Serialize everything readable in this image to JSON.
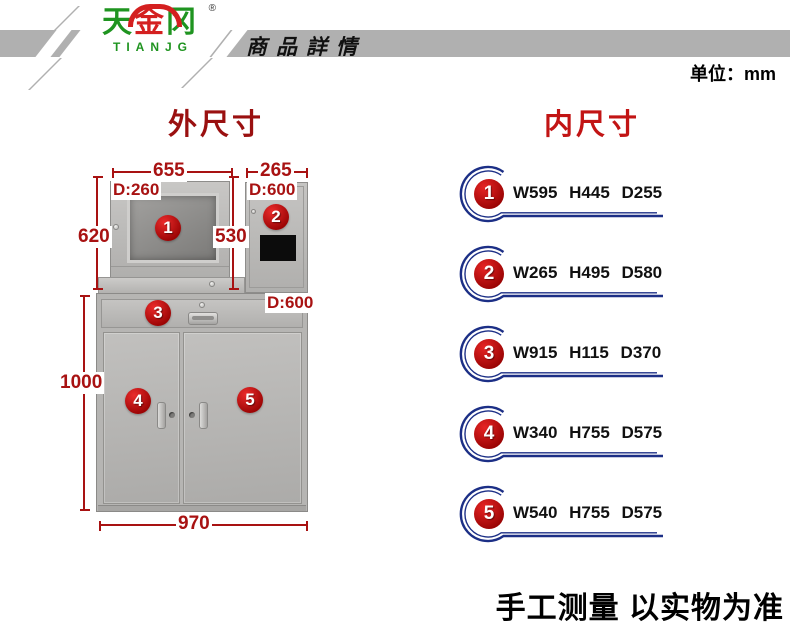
{
  "header": {
    "brand": {
      "tian": "天",
      "jin": "金",
      "gang": "冈",
      "reg": "®",
      "latin": "TIANJG"
    },
    "title": "商品詳情",
    "unit_label": "单位：mm"
  },
  "sections": {
    "outer_title": "外尺寸",
    "inner_title": "内尺寸"
  },
  "diagram": {
    "dims": {
      "top_width": "655",
      "top_right_width": "265",
      "depth_monitor": "D:260",
      "depth_right_top": "D:600",
      "height_left": "620",
      "height_mid": "530",
      "depth_lower": "D:600",
      "height_lower": "1000",
      "bottom_width": "970"
    },
    "badges": [
      "1",
      "2",
      "3",
      "4",
      "5"
    ]
  },
  "inner_list": {
    "items": [
      {
        "num": "1",
        "spec": "W595 H445 D255"
      },
      {
        "num": "2",
        "spec": "W265 H495 D580"
      },
      {
        "num": "3",
        "spec": "W915 H115 D370"
      },
      {
        "num": "4",
        "spec": "W340 H755 D575"
      },
      {
        "num": "5",
        "spec": "W540 H755 D575"
      }
    ]
  },
  "footer": {
    "note": "手工测量 以实物为准"
  },
  "colors": {
    "accent_red": "#a81212",
    "badge_red": "#c00000",
    "swirl_blue": "#1c2f86",
    "bar_gray": "#b0b0b0",
    "logo_green": "#1f9420",
    "logo_red": "#d42020"
  }
}
